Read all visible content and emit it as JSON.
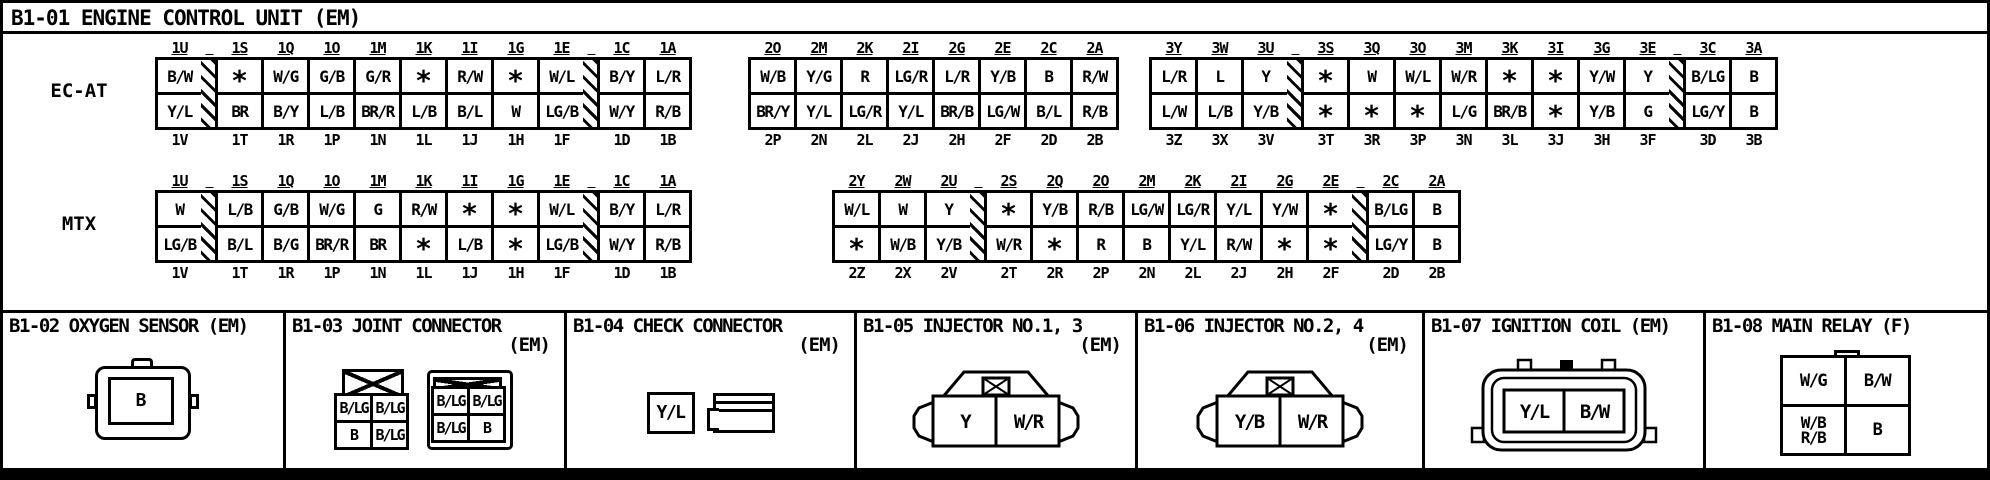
{
  "ecu": {
    "title": "B1-01 ENGINE CONTROL UNIT (EM)",
    "rows": [
      {
        "label": "EC-AT",
        "groups": [
          {
            "headers": [
              "1U",
              "1S",
              "1Q",
              "1O",
              "1M",
              "1K",
              "1I",
              "1G",
              "1E",
              "1C",
              "1A"
            ],
            "row1": [
              "B/W",
              "*",
              "W/G",
              "G/B",
              "G/R",
              "*",
              "R/W",
              "*",
              "W/L",
              "B/Y",
              "L/R"
            ],
            "row2": [
              "Y/L",
              "BR",
              "B/Y",
              "L/B",
              "BR/R",
              "L/B",
              "B/L",
              "W",
              "LG/B",
              "W/Y",
              "R/B"
            ],
            "footers": [
              "1V",
              "1T",
              "1R",
              "1P",
              "1N",
              "1L",
              "1J",
              "1H",
              "1F",
              "1D",
              "1B"
            ],
            "hatch_after_index": [
              0,
              8
            ]
          },
          {
            "headers": [
              "2O",
              "2M",
              "2K",
              "2I",
              "2G",
              "2E",
              "2C",
              "2A"
            ],
            "row1": [
              "W/B",
              "Y/G",
              "R",
              "LG/R",
              "L/R",
              "Y/B",
              "B",
              "R/W"
            ],
            "row2": [
              "BR/Y",
              "Y/L",
              "LG/R",
              "Y/L",
              "BR/B",
              "LG/W",
              "B/L",
              "R/B"
            ],
            "footers": [
              "2P",
              "2N",
              "2L",
              "2J",
              "2H",
              "2F",
              "2D",
              "2B"
            ],
            "hatch_after_index": []
          },
          {
            "headers": [
              "3Y",
              "3W",
              "3U",
              "3S",
              "3Q",
              "3O",
              "3M",
              "3K",
              "3I",
              "3G",
              "3E",
              "3C",
              "3A"
            ],
            "row1": [
              "L/R",
              "L",
              "Y",
              "*",
              "W",
              "W/L",
              "W/R",
              "*",
              "*",
              "Y/W",
              "Y",
              "B/LG",
              "B"
            ],
            "row2": [
              "L/W",
              "L/B",
              "Y/B",
              "*",
              "*",
              "*",
              "L/G",
              "BR/B",
              "*",
              "Y/B",
              "G",
              "LG/Y",
              "B"
            ],
            "footers": [
              "3Z",
              "3X",
              "3V",
              "3T",
              "3R",
              "3P",
              "3N",
              "3L",
              "3J",
              "3H",
              "3F",
              "3D",
              "3B"
            ],
            "hatch_after_index": [
              2,
              10
            ]
          }
        ]
      },
      {
        "label": "MTX",
        "groups": [
          {
            "headers": [
              "1U",
              "1S",
              "1Q",
              "1O",
              "1M",
              "1K",
              "1I",
              "1G",
              "1E",
              "1C",
              "1A"
            ],
            "row1": [
              "W",
              "L/B",
              "G/B",
              "W/G",
              "G",
              "R/W",
              "*",
              "*",
              "W/L",
              "B/Y",
              "L/R"
            ],
            "row2": [
              "LG/B",
              "B/L",
              "B/G",
              "BR/R",
              "BR",
              "*",
              "L/B",
              "*",
              "LG/B",
              "W/Y",
              "R/B"
            ],
            "footers": [
              "1V",
              "1T",
              "1R",
              "1P",
              "1N",
              "1L",
              "1J",
              "1H",
              "1F",
              "1D",
              "1B"
            ],
            "hatch_after_index": [
              0,
              8
            ]
          },
          {
            "headers": [
              "2Y",
              "2W",
              "2U",
              "2S",
              "2Q",
              "2O",
              "2M",
              "2K",
              "2I",
              "2G",
              "2E",
              "2C",
              "2A"
            ],
            "row1": [
              "W/L",
              "W",
              "Y",
              "*",
              "Y/B",
              "R/B",
              "LG/W",
              "LG/R",
              "Y/L",
              "Y/W",
              "*",
              "B/LG",
              "B"
            ],
            "row2": [
              "*",
              "W/B",
              "Y/B",
              "W/R",
              "*",
              "R",
              "B",
              "Y/L",
              "R/W",
              "*",
              "*",
              "LG/Y",
              "B"
            ],
            "footers": [
              "2Z",
              "2X",
              "2V",
              "2T",
              "2R",
              "2P",
              "2N",
              "2L",
              "2J",
              "2H",
              "2F",
              "2D",
              "2B"
            ],
            "hatch_after_index": [
              2,
              10
            ]
          }
        ]
      }
    ]
  },
  "panels": {
    "oxygen": {
      "title": "B1-02 OXYGEN SENSOR (EM)",
      "pin": "B"
    },
    "joint": {
      "title": "B1-03 JOINT CONNECTOR",
      "subtitle": "(EM)",
      "left_grid": [
        "B/LG",
        "B/LG",
        "B",
        "B/LG"
      ],
      "right_grid": [
        "B/LG",
        "B/LG",
        "B/LG",
        "B"
      ]
    },
    "check": {
      "title": "B1-04 CHECK CONNECTOR",
      "subtitle": "(EM)",
      "pin": "Y/L"
    },
    "injector13": {
      "title": "B1-05 INJECTOR NO.1, 3",
      "subtitle": "(EM)",
      "pins": [
        "Y",
        "W/R"
      ]
    },
    "injector24": {
      "title": "B1-06 INJECTOR NO.2, 4",
      "subtitle": "(EM)",
      "pins": [
        "Y/B",
        "W/R"
      ]
    },
    "ignition": {
      "title": "B1-07 IGNITION COIL (EM)",
      "pins": [
        "Y/L",
        "B/W"
      ]
    },
    "mainrelay": {
      "title": "B1-08 MAIN RELAY (F)",
      "pins": {
        "tl": "W/G",
        "tr": "B/W",
        "bl_top": "W/B",
        "bl_bottom": "R/B",
        "br": "B"
      }
    }
  },
  "colors": {
    "ink": "#000000",
    "paper": "#ffffff"
  }
}
